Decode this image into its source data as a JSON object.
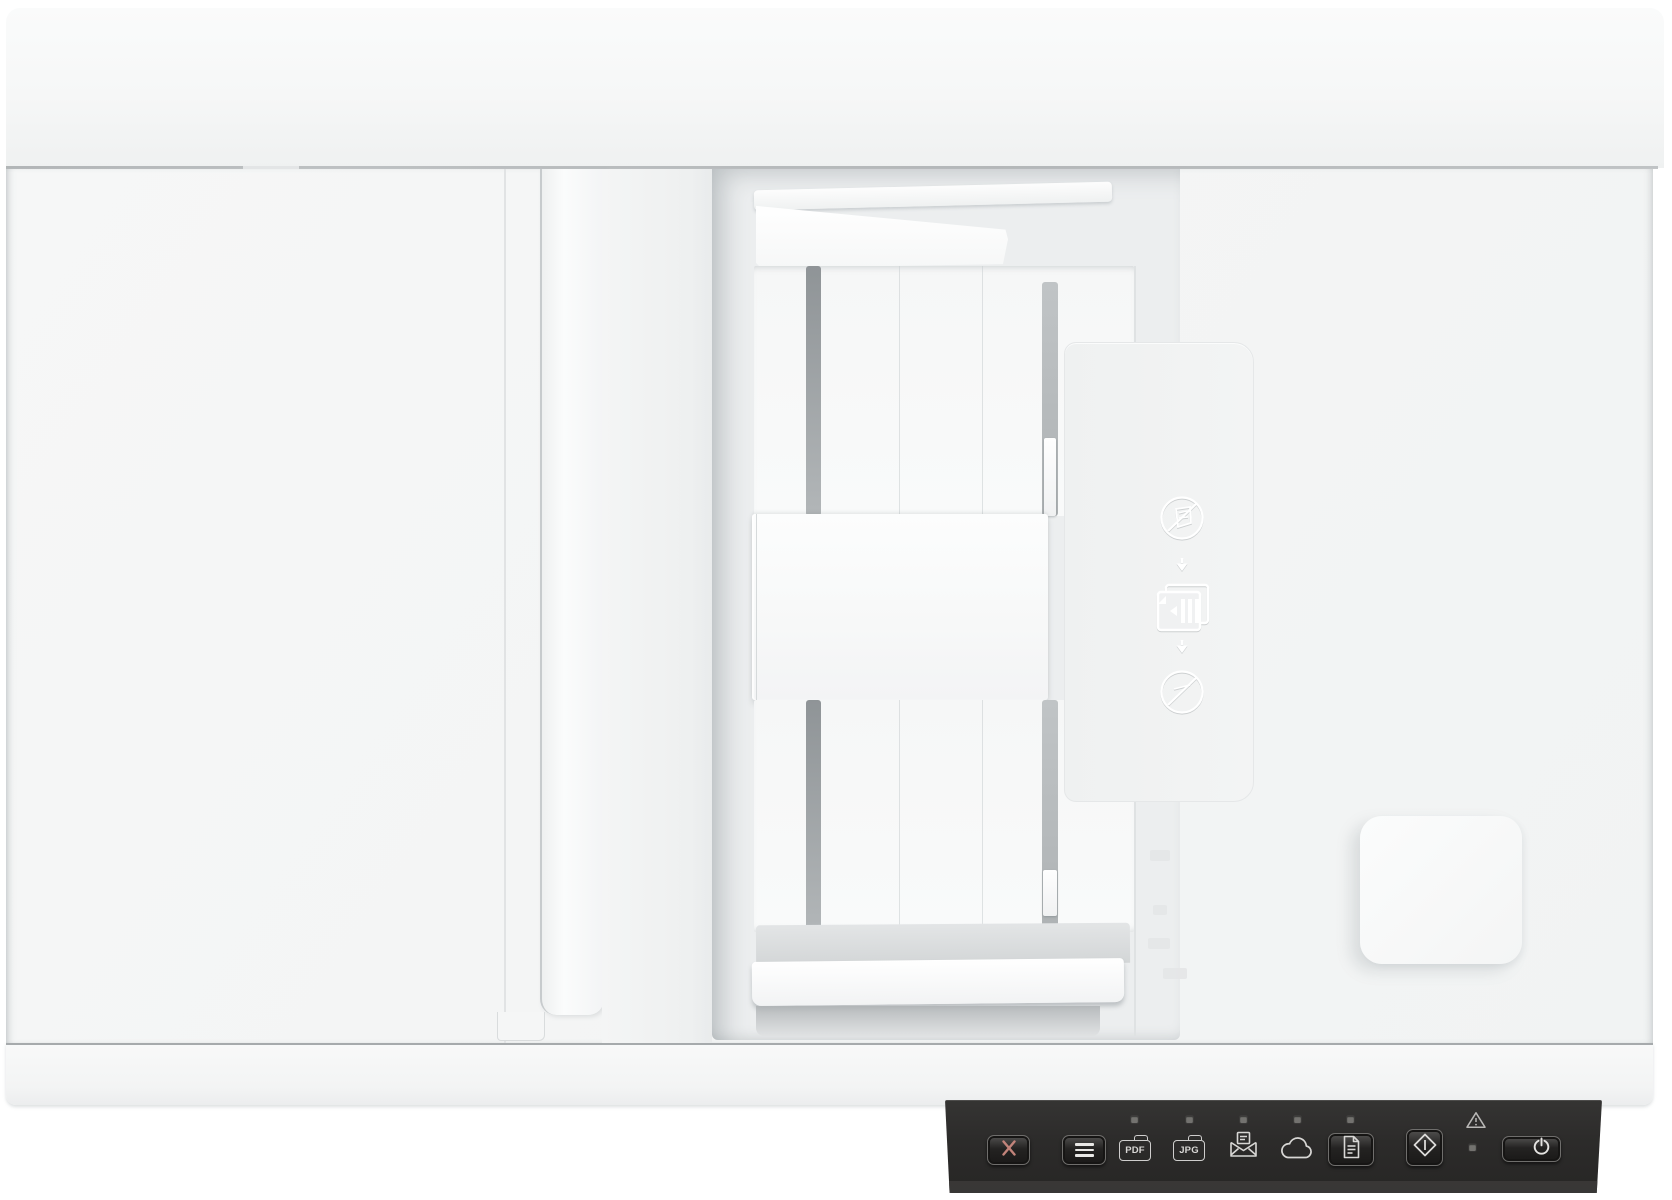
{
  "meta": {
    "description": "Top-down product photo of a white flatbed document scanner with automatic document feeder and a dark front control panel"
  },
  "colors": {
    "body": "#f5f6f6",
    "tray_recess": "#eceeef",
    "panel_background": "#2d2c2b",
    "button_glyph": "#d8d7d5",
    "cancel_x": "#c2837a",
    "led": "#73726f",
    "slot": "#9aa0a3"
  },
  "control_panel": {
    "cancel_button": {
      "icon": "x-icon"
    },
    "menu_button": {
      "icon": "menu-icon"
    },
    "destinations": [
      {
        "id": "pdf",
        "label": "PDF",
        "icon": "pdf-folder-icon",
        "led": true
      },
      {
        "id": "jpg",
        "label": "JPG",
        "icon": "jpg-folder-icon",
        "led": true
      },
      {
        "id": "email",
        "label": "",
        "icon": "email-icon",
        "led": true
      },
      {
        "id": "cloud",
        "label": "",
        "icon": "cloud-icon",
        "led": true
      },
      {
        "id": "document",
        "label": "",
        "icon": "document-icon",
        "led": true
      }
    ],
    "scan_button": {
      "icon": "start-scan-icon"
    },
    "error_indicator": {
      "icon": "warning-triangle-icon",
      "led": true
    },
    "power_button": {
      "icon": "power-icon"
    }
  },
  "adf_markings": {
    "icons": [
      "no-stapled-media-icon",
      "down-arrow-icon",
      "feed-documents-icon",
      "down-arrow-icon",
      "no-fragile-media-icon"
    ]
  }
}
